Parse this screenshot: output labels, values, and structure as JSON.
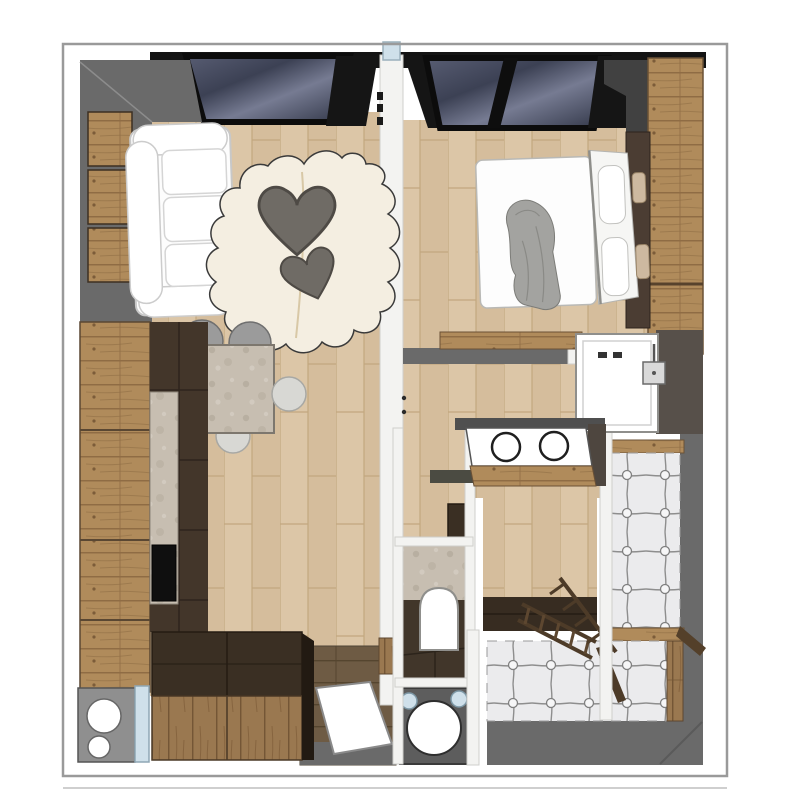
{
  "page": {
    "background": "#ffffff",
    "border": "#9a9a9a",
    "title": "apartment-floor-plan-top-view-3d-render"
  },
  "colors": {
    "page-bg": "#ffffff",
    "outline": "#9a9a9a",
    "wall-gray": "#6a6a6a",
    "wall-white": "#f3f3f1",
    "wall-black": "#141414",
    "glass-dark": "#3c4154",
    "glass-mid": "#6d7389",
    "floor-wood": "#dcc6a7",
    "floor-wood-line": "#c2a77f",
    "wood-light": "#b08b5b",
    "wood-mid": "#8a6844",
    "wood-dark": "#43362a",
    "wood-chest": "#3a2f23",
    "stone": "#c7beb1",
    "fixture-white": "#ffffff",
    "sofa-white": "#fdfdfd",
    "rug-cream": "#f4eee1",
    "heart-gray": "#6f6b65",
    "chair-gray": "#9b9b9b",
    "chair-light": "#d8d8d4",
    "tuft": "#ebebed",
    "tuft-line": "#8e8e8e",
    "appliance-gray": "#8f8f8f",
    "machine-gray": "#5d5d5d",
    "accent-blue": "#cfe0ea",
    "blanket-gray": "#a3a3a0",
    "table-stone": "#b9b0a5"
  },
  "plan": {
    "title": "apartment-floor-plan",
    "style": "sketchup-top-view-render",
    "rooms": [
      {
        "id": "living-room",
        "label": "living room",
        "features": [
          "white-sofa",
          "cowhide-rug",
          "heart-coffee-table",
          "stone-dining-table",
          "chairs",
          "wood-wall-shelves",
          "window"
        ]
      },
      {
        "id": "kitchen",
        "label": "kitchen",
        "features": [
          "wood-cabinets",
          "stone-counter",
          "black-cooktop",
          "storage-chest",
          "sink-unit"
        ]
      },
      {
        "id": "bedroom",
        "label": "bedroom",
        "features": [
          "double-bed",
          "pillows",
          "gray-throw-blanket",
          "wood-wardrobe-wall",
          "foot-bench",
          "window"
        ]
      },
      {
        "id": "bathroom",
        "label": "bathroom",
        "features": [
          "walk-in-shower",
          "shower-head",
          "double-sink-vanity"
        ]
      },
      {
        "id": "wc",
        "label": "wc",
        "features": [
          "toilet",
          "stone-wall"
        ]
      },
      {
        "id": "laundry",
        "label": "laundry closet",
        "features": [
          "washing-machine"
        ]
      },
      {
        "id": "entrance",
        "label": "entrance",
        "features": [
          "doormat",
          "wood-door"
        ]
      },
      {
        "id": "lounge-pit",
        "label": "sunken tufted lounge",
        "features": [
          "tufted-upholstery",
          "wood-ladder",
          "wood-railing",
          "wood-platform"
        ]
      }
    ]
  }
}
